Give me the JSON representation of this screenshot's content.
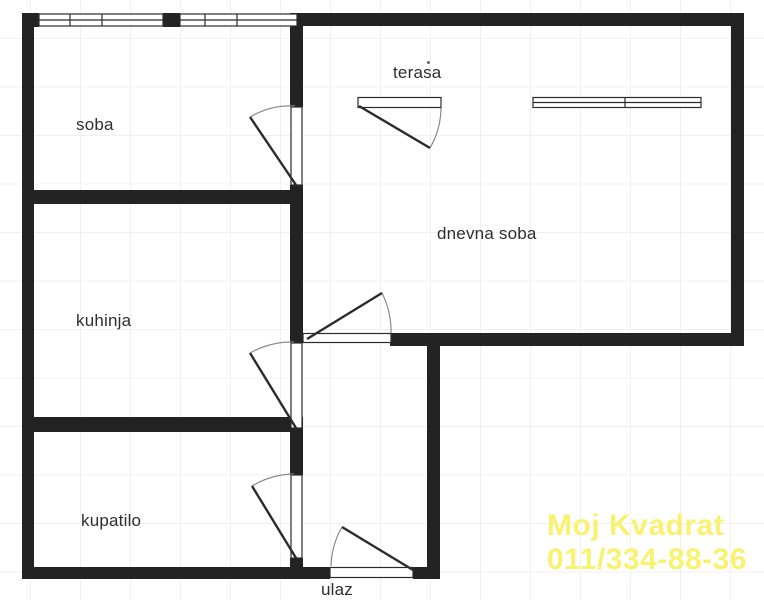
{
  "plan_labels": {
    "soba": "soba",
    "terasa": "terasa",
    "dnevna_soba": "dnevna soba",
    "kuhinja": "kuhinja",
    "kupatilo": "kupatilo",
    "ulaz": "ulaz"
  },
  "watermark": {
    "line1": "Moj Kvadrat",
    "line2": "011/334-88-36",
    "color": "#f9f166"
  },
  "colors": {
    "wall": "#232323",
    "thin_line": "#2b2b2b",
    "door_arc": "#8a8a8a",
    "grid_line": "#f0f0f0",
    "background": "#ffffff",
    "label_text": "#2e2e2e"
  }
}
